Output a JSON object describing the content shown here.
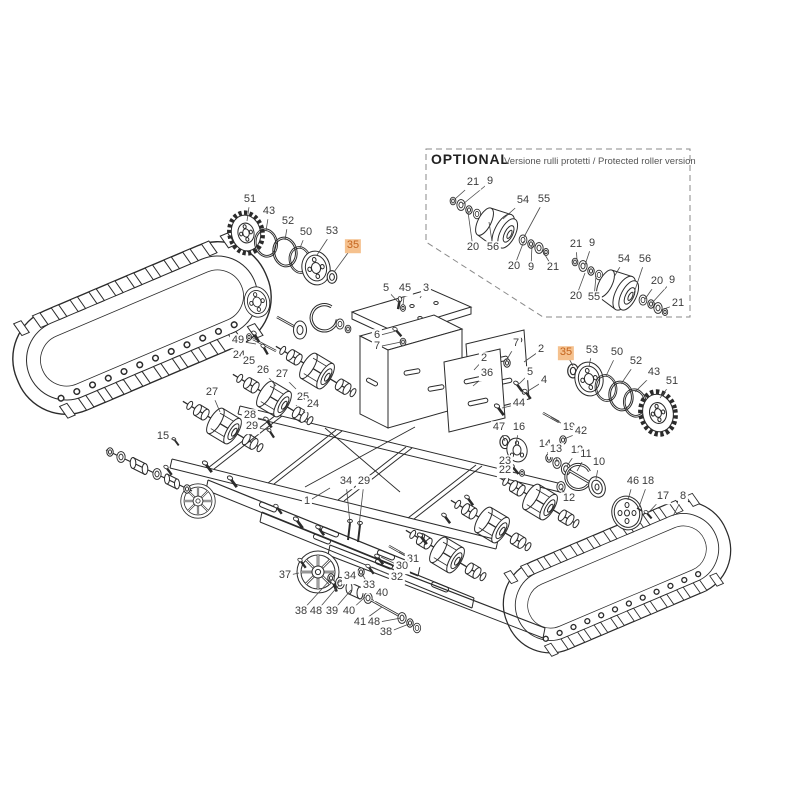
{
  "page": {
    "background": "#ffffff"
  },
  "optional_panel": {
    "title": "OPTIONAL",
    "subtitle": "Versione rulli protetti / Protected roller version"
  },
  "colors": {
    "line": "#2b2b2b",
    "leader": "#4a4a4a",
    "highlight_bg": "#f5c18e",
    "highlight_text": "#c4641d",
    "label_text": "#3c3c3c"
  },
  "parts_labels": [
    {
      "n": "51",
      "x": 250,
      "y": 200,
      "lx": 247,
      "ly": 221
    },
    {
      "n": "43",
      "x": 269,
      "y": 212,
      "lx": 266,
      "ly": 231
    },
    {
      "n": "52",
      "x": 288,
      "y": 222,
      "lx": 285,
      "ly": 240
    },
    {
      "n": "50",
      "x": 306,
      "y": 233,
      "lx": 300,
      "ly": 248
    },
    {
      "n": "53",
      "x": 332,
      "y": 232,
      "lx": 317,
      "ly": 255
    },
    {
      "n": "35",
      "x": 353,
      "y": 246,
      "lx": 334,
      "ly": 272,
      "hl": true
    },
    {
      "n": "21",
      "x": 473,
      "y": 183,
      "lx": 455,
      "ly": 199
    },
    {
      "n": "9",
      "x": 490,
      "y": 182,
      "lx": 463,
      "ly": 204
    },
    {
      "n": "54",
      "x": 523,
      "y": 201,
      "lx": 503,
      "ly": 219
    },
    {
      "n": "55",
      "x": 544,
      "y": 200,
      "lx": 524,
      "ly": 237
    },
    {
      "n": "20",
      "x": 473,
      "y": 248,
      "lx": 468,
      "ly": 212
    },
    {
      "n": "56",
      "x": 493,
      "y": 248,
      "lx": 489,
      "ly": 222
    },
    {
      "n": "20",
      "x": 514,
      "y": 267,
      "lx": 524,
      "ly": 241
    },
    {
      "n": "9",
      "x": 531,
      "y": 268,
      "lx": 532,
      "ly": 245
    },
    {
      "n": "21",
      "x": 553,
      "y": 268,
      "lx": 542,
      "ly": 250
    },
    {
      "n": "21",
      "x": 576,
      "y": 245,
      "lx": 577,
      "ly": 260
    },
    {
      "n": "9",
      "x": 592,
      "y": 244,
      "lx": 585,
      "ly": 265
    },
    {
      "n": "54",
      "x": 624,
      "y": 260,
      "lx": 614,
      "ly": 277
    },
    {
      "n": "56",
      "x": 645,
      "y": 260,
      "lx": 634,
      "ly": 293
    },
    {
      "n": "20",
      "x": 657,
      "y": 282,
      "lx": 645,
      "ly": 299
    },
    {
      "n": "9",
      "x": 672,
      "y": 281,
      "lx": 652,
      "ly": 303
    },
    {
      "n": "20",
      "x": 576,
      "y": 297,
      "lx": 585,
      "ly": 273
    },
    {
      "n": "55",
      "x": 594,
      "y": 298,
      "lx": 596,
      "ly": 276
    },
    {
      "n": "21",
      "x": 678,
      "y": 304,
      "lx": 661,
      "ly": 310
    },
    {
      "n": "5",
      "x": 386,
      "y": 289,
      "lx": 399,
      "ly": 303
    },
    {
      "n": "45",
      "x": 405,
      "y": 289,
      "lx": 403,
      "ly": 305
    },
    {
      "n": "3",
      "x": 426,
      "y": 289,
      "lx": 420,
      "ly": 298
    },
    {
      "n": "6",
      "x": 377,
      "y": 336,
      "lx": 396,
      "ly": 331
    },
    {
      "n": "7",
      "x": 377,
      "y": 347,
      "lx": 401,
      "ly": 342
    },
    {
      "n": "7",
      "x": 516,
      "y": 344,
      "lx": 506,
      "ly": 361
    },
    {
      "n": "2",
      "x": 541,
      "y": 350,
      "lx": 524,
      "ly": 362
    },
    {
      "n": "2",
      "x": 484,
      "y": 359,
      "lx": 474,
      "ly": 370
    },
    {
      "n": "36",
      "x": 487,
      "y": 374,
      "lx": 473,
      "ly": 386
    },
    {
      "n": "5",
      "x": 530,
      "y": 373,
      "lx": 519,
      "ly": 384
    },
    {
      "n": "4",
      "x": 544,
      "y": 381,
      "lx": 528,
      "ly": 391
    },
    {
      "n": "44",
      "x": 519,
      "y": 404,
      "lx": 502,
      "ly": 408
    },
    {
      "n": "35",
      "x": 566,
      "y": 353,
      "lx": 573,
      "ly": 366,
      "hl": true
    },
    {
      "n": "53",
      "x": 592,
      "y": 351,
      "lx": 589,
      "ly": 367
    },
    {
      "n": "50",
      "x": 617,
      "y": 353,
      "lx": 606,
      "ly": 376
    },
    {
      "n": "52",
      "x": 636,
      "y": 362,
      "lx": 621,
      "ly": 384
    },
    {
      "n": "43",
      "x": 654,
      "y": 373,
      "lx": 635,
      "ly": 392
    },
    {
      "n": "51",
      "x": 672,
      "y": 382,
      "lx": 660,
      "ly": 398
    },
    {
      "n": "47",
      "x": 499,
      "y": 428,
      "lx": 505,
      "ly": 441
    },
    {
      "n": "16",
      "x": 519,
      "y": 428,
      "lx": 516,
      "ly": 444
    },
    {
      "n": "19",
      "x": 569,
      "y": 428,
      "lx": 551,
      "ly": 417
    },
    {
      "n": "42",
      "x": 581,
      "y": 432,
      "lx": 564,
      "ly": 439
    },
    {
      "n": "14",
      "x": 545,
      "y": 445,
      "lx": 549,
      "ly": 457
    },
    {
      "n": "13",
      "x": 556,
      "y": 450,
      "lx": 557,
      "ly": 462
    },
    {
      "n": "12",
      "x": 577,
      "y": 451,
      "lx": 567,
      "ly": 466
    },
    {
      "n": "11",
      "x": 586,
      "y": 455,
      "lx": 577,
      "ly": 471
    },
    {
      "n": "10",
      "x": 599,
      "y": 463,
      "lx": 596,
      "ly": 479
    },
    {
      "n": "23",
      "x": 505,
      "y": 462,
      "lx": 513,
      "ly": 467
    },
    {
      "n": "22",
      "x": 505,
      "y": 471,
      "lx": 516,
      "ly": 473
    },
    {
      "n": "12",
      "x": 569,
      "y": 499,
      "lx": 561,
      "ly": 488
    },
    {
      "n": "46",
      "x": 633,
      "y": 482,
      "lx": 628,
      "ly": 500
    },
    {
      "n": "18",
      "x": 648,
      "y": 482,
      "lx": 639,
      "ly": 507
    },
    {
      "n": "17",
      "x": 663,
      "y": 497,
      "lx": 649,
      "ly": 512
    },
    {
      "n": "8",
      "x": 683,
      "y": 497,
      "lx": 673,
      "ly": 516
    },
    {
      "n": "49",
      "x": 238,
      "y": 341,
      "lx": 256,
      "ly": 344
    },
    {
      "n": "24",
      "x": 239,
      "y": 356,
      "lx": 252,
      "ly": 367
    },
    {
      "n": "25",
      "x": 249,
      "y": 362,
      "lx": 257,
      "ly": 371
    },
    {
      "n": "26",
      "x": 263,
      "y": 371,
      "lx": 276,
      "ly": 386
    },
    {
      "n": "27",
      "x": 282,
      "y": 375,
      "lx": 296,
      "ly": 389
    },
    {
      "n": "27",
      "x": 212,
      "y": 393,
      "lx": 220,
      "ly": 412
    },
    {
      "n": "25",
      "x": 303,
      "y": 398,
      "lx": 296,
      "ly": 406
    },
    {
      "n": "24",
      "x": 313,
      "y": 405,
      "lx": 303,
      "ly": 412
    },
    {
      "n": "28",
      "x": 250,
      "y": 416,
      "lx": 266,
      "ly": 420
    },
    {
      "n": "29",
      "x": 252,
      "y": 427,
      "lx": 269,
      "ly": 430
    },
    {
      "n": "15",
      "x": 163,
      "y": 437,
      "lx": 176,
      "ly": 440
    },
    {
      "n": "1",
      "x": 307,
      "y": 502,
      "lx": 330,
      "ly": 488
    },
    {
      "n": "34",
      "x": 346,
      "y": 482,
      "lx": 350,
      "ly": 524
    },
    {
      "n": "29",
      "x": 364,
      "y": 482,
      "lx": 359,
      "ly": 526
    },
    {
      "n": "31",
      "x": 413,
      "y": 560,
      "lx": 399,
      "ly": 552
    },
    {
      "n": "30",
      "x": 402,
      "y": 567,
      "lx": 381,
      "ly": 557
    },
    {
      "n": "32",
      "x": 397,
      "y": 578,
      "lx": 372,
      "ly": 567
    },
    {
      "n": "33",
      "x": 369,
      "y": 586,
      "lx": 362,
      "ly": 574
    },
    {
      "n": "37",
      "x": 285,
      "y": 576,
      "lx": 299,
      "ly": 573
    },
    {
      "n": "34",
      "x": 350,
      "y": 577,
      "lx": 337,
      "ly": 583
    },
    {
      "n": "40",
      "x": 382,
      "y": 594,
      "lx": 374,
      "ly": 601
    },
    {
      "n": "38",
      "x": 301,
      "y": 612,
      "lx": 330,
      "ly": 580
    },
    {
      "n": "48",
      "x": 316,
      "y": 612,
      "lx": 339,
      "ly": 585
    },
    {
      "n": "39",
      "x": 332,
      "y": 612,
      "lx": 351,
      "ly": 590
    },
    {
      "n": "40",
      "x": 349,
      "y": 612,
      "lx": 365,
      "ly": 597
    },
    {
      "n": "41",
      "x": 360,
      "y": 623,
      "lx": 382,
      "ly": 607
    },
    {
      "n": "48",
      "x": 374,
      "y": 623,
      "lx": 401,
      "ly": 618
    },
    {
      "n": "38",
      "x": 386,
      "y": 633,
      "lx": 409,
      "ly": 624
    }
  ]
}
